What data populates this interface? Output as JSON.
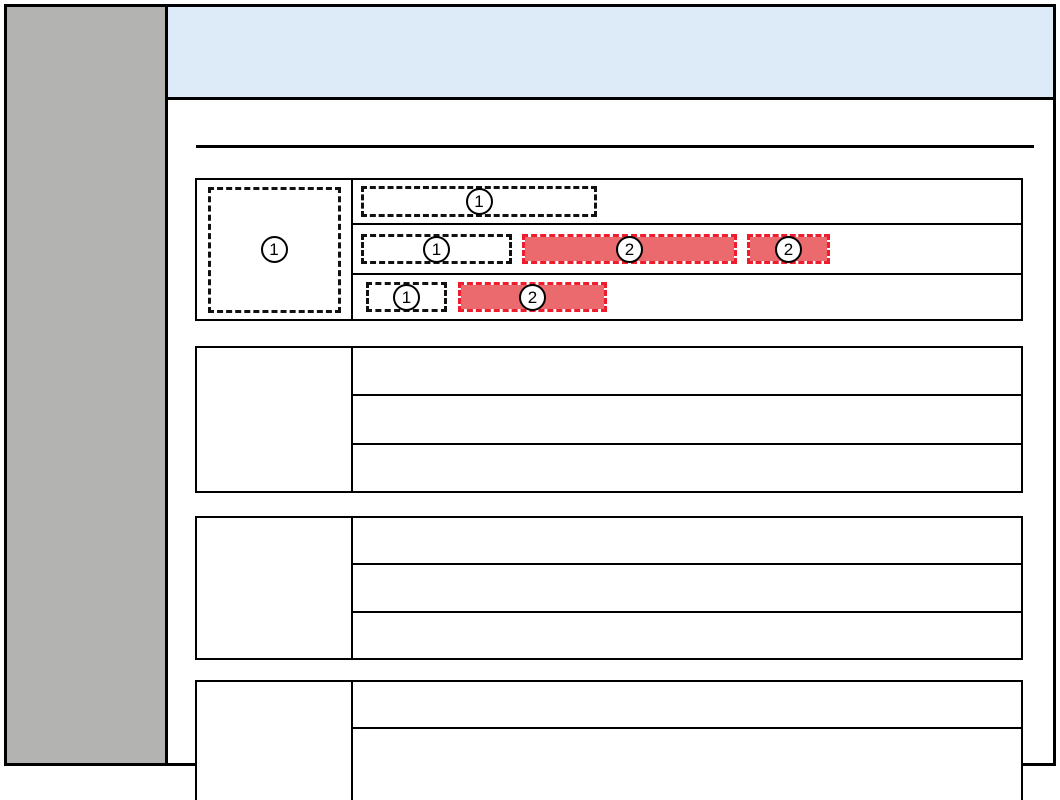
{
  "palette": {
    "page_background": "#ffffff",
    "frame_border": "#000000",
    "sidebar_fill": "#b3b3b1",
    "header_fill": "#dcebf7",
    "table_border": "#000000",
    "placeholder_dash": "#111111",
    "highlight_fill": "#ea6a6e",
    "highlight_dash": "#ee1c2c"
  },
  "markers": {
    "image_placeholder": "1",
    "highlight_placeholder": "2"
  },
  "table1": {
    "left_cell": {
      "marker": "1"
    },
    "rows": [
      {
        "items": [
          {
            "type": "image-placeholder",
            "marker": "1"
          }
        ]
      },
      {
        "items": [
          {
            "type": "image-placeholder",
            "marker": "1"
          },
          {
            "type": "highlight",
            "marker": "2"
          },
          {
            "type": "highlight",
            "marker": "2"
          }
        ]
      },
      {
        "items": [
          {
            "type": "image-placeholder",
            "marker": "1"
          },
          {
            "type": "highlight",
            "marker": "2"
          }
        ]
      }
    ]
  },
  "table2": {
    "row_count": 3
  },
  "table3": {
    "row_count": 3
  },
  "table4": {
    "row_count": 2
  }
}
